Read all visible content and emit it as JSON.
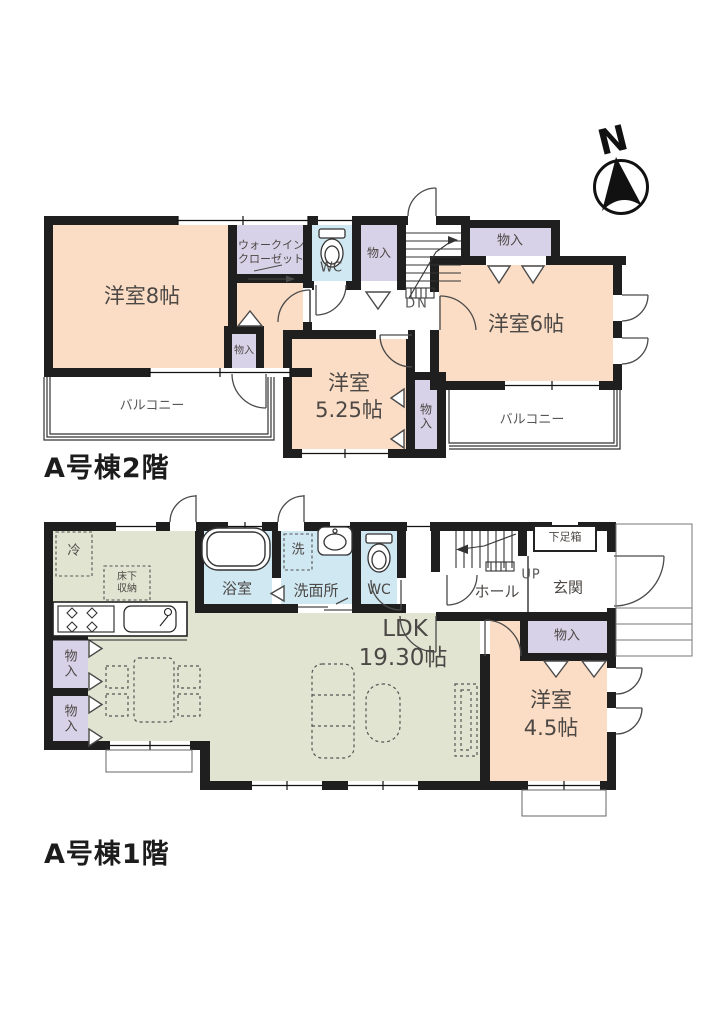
{
  "compass": {
    "north": "N"
  },
  "floor2": {
    "title": "A号棟2階",
    "labels": {
      "room8": "洋室8帖",
      "wic1": "ウォークイン",
      "wic2": "クローゼット",
      "wc": "WC",
      "mono_wc": "物入",
      "mono_top": "物入",
      "dn": "DN",
      "room6": "洋室6帖",
      "mono_mid": "物入",
      "room525_1": "洋室",
      "room525_2": "5.25帖",
      "mono_525": "物入",
      "balcony_left": "バルコニー",
      "balcony_right": "バルコニー"
    }
  },
  "floor1": {
    "title": "A号棟1階",
    "labels": {
      "rei": "冷",
      "yukashita1": "床下",
      "yukashita2": "収納",
      "bath": "浴室",
      "sen": "洗",
      "senmenjo": "洗面所",
      "wc": "WC",
      "up": "UP",
      "hall": "ホール",
      "genkan": "玄関",
      "getabako": "下足箱",
      "mono_genkan": "物入",
      "mono_left1": "物入",
      "mono_left2": "物入",
      "ldk1": "LDK",
      "ldk2": "19.30帖",
      "room45_1": "洋室",
      "room45_2": "4.5帖"
    }
  },
  "colors": {
    "room_peach": "#fbdcc4",
    "storage_lavender": "#d7d2e7",
    "wet_blue": "#cfe8f2",
    "ldk_sage": "#e1e4d1",
    "wall": "#1f1f1f",
    "label": "#4c4845"
  }
}
